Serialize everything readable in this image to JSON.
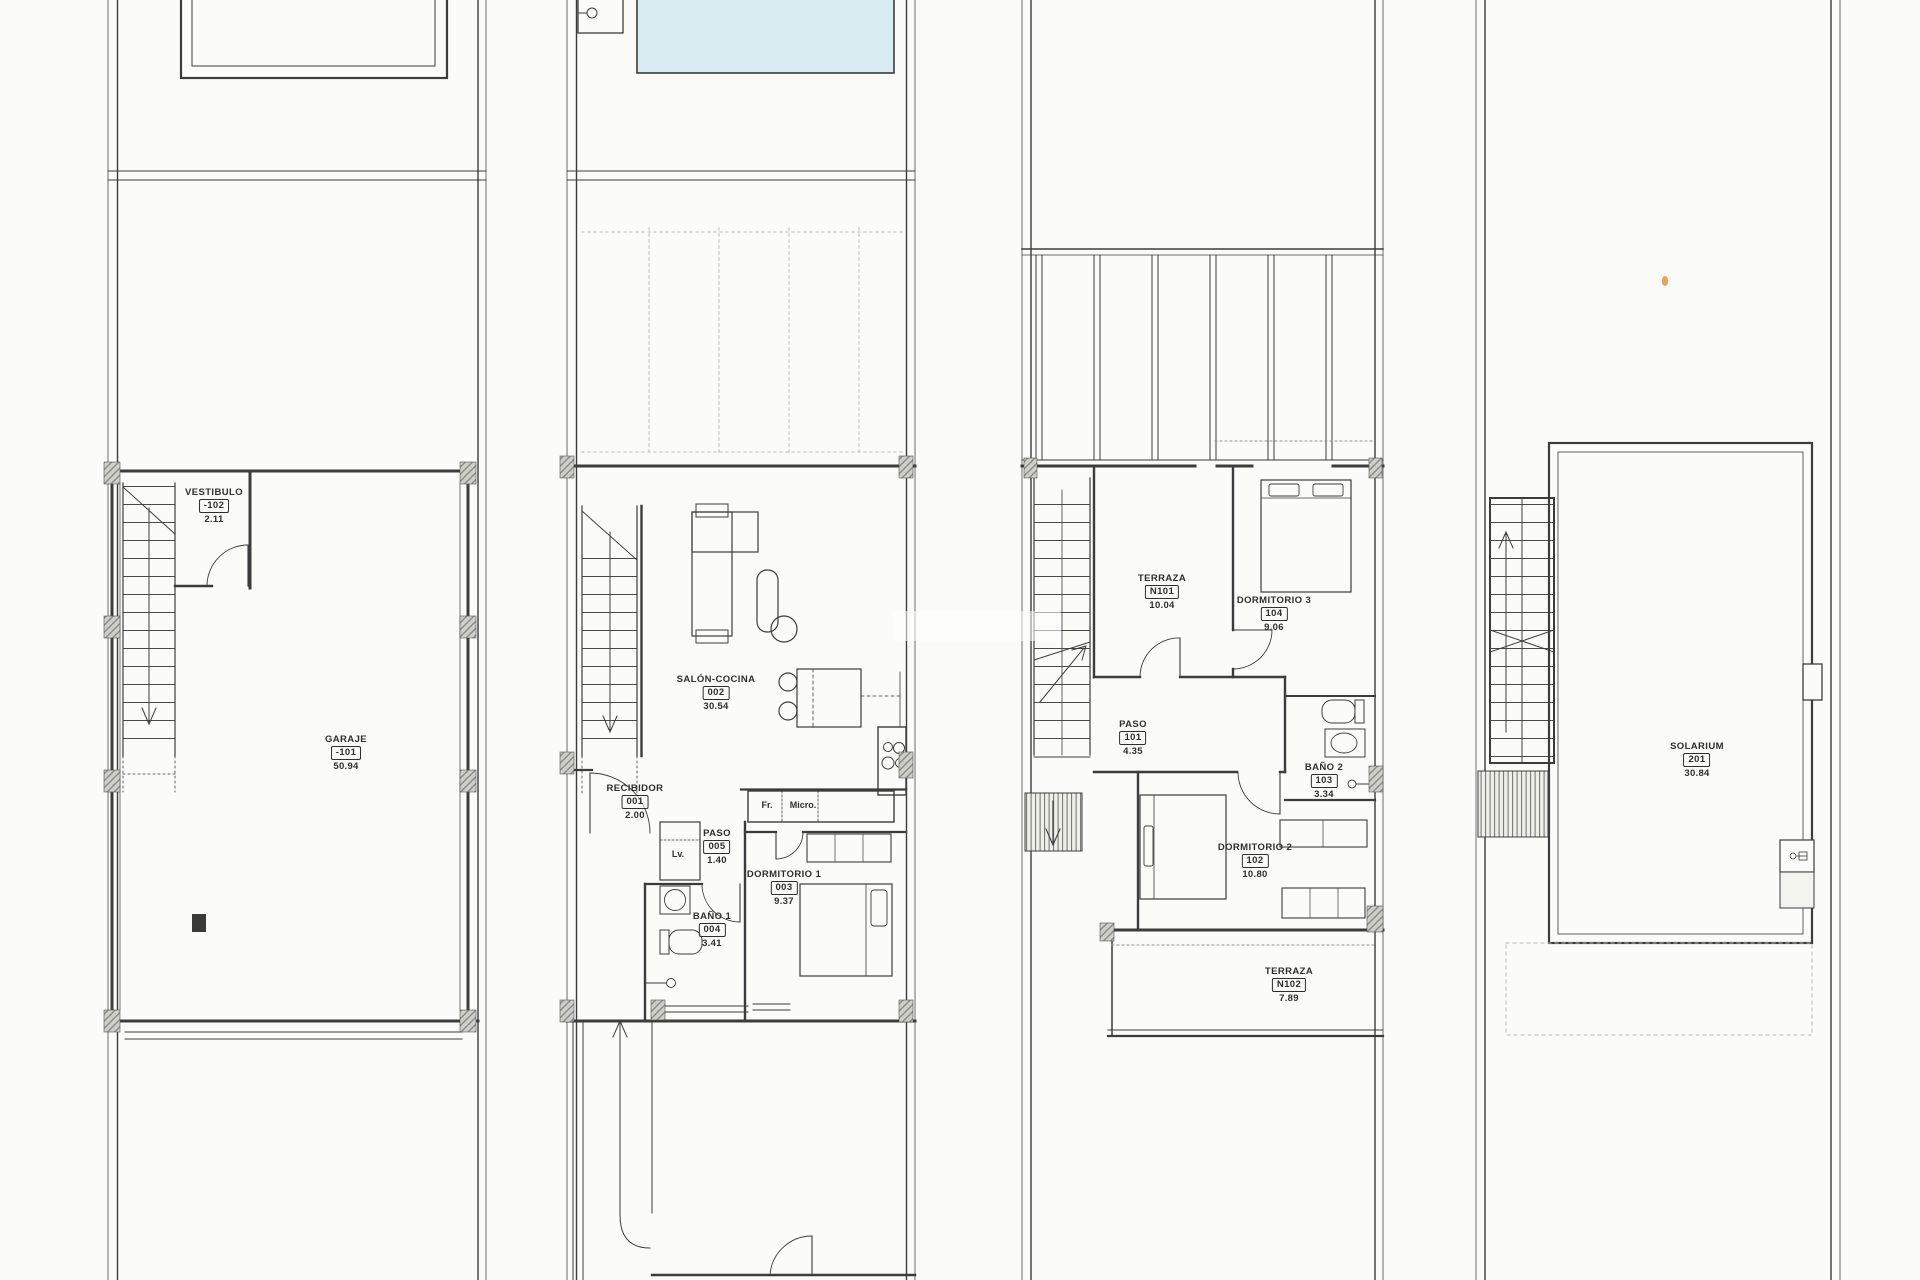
{
  "sheet": {
    "background": "#fbfbf8",
    "line_color": "#3c3c3c",
    "pool_color": "#d8ecf1",
    "hatch_color": "#cfcfca"
  },
  "plans": [
    {
      "rooms": [
        {
          "name": "VESTIBULO",
          "code": "-102",
          "area": "2.11"
        },
        {
          "name": "GARAJE",
          "code": "-101",
          "area": "50.94"
        }
      ]
    },
    {
      "rooms": [
        {
          "name": "SALÓN-COCINA",
          "code": "002",
          "area": "30.54"
        },
        {
          "name": "RECIBIDOR",
          "code": "001",
          "area": "2.00"
        },
        {
          "name": "PASO",
          "code": "005",
          "area": "1.40"
        },
        {
          "name": "BAÑO 1",
          "code": "004",
          "area": "3.41"
        },
        {
          "name": "DORMITORIO 1",
          "code": "003",
          "area": "9.37"
        }
      ],
      "appliances": {
        "washer": "Lv.",
        "fridge": "Fr.",
        "microwave": "Micro."
      }
    },
    {
      "rooms": [
        {
          "name": "TERRAZA",
          "code": "N101",
          "area": "10.04"
        },
        {
          "name": "DORMITORIO 3",
          "code": "104",
          "area": "9.06"
        },
        {
          "name": "PASO",
          "code": "101",
          "area": "4.35"
        },
        {
          "name": "BAÑO 2",
          "code": "103",
          "area": "3.34"
        },
        {
          "name": "DORMITORIO 2",
          "code": "102",
          "area": "10.80"
        },
        {
          "name": "TERRAZA",
          "code": "N102",
          "area": "7.89"
        }
      ]
    },
    {
      "rooms": [
        {
          "name": "SOLARIUM",
          "code": "201",
          "area": "30.84"
        }
      ]
    }
  ]
}
